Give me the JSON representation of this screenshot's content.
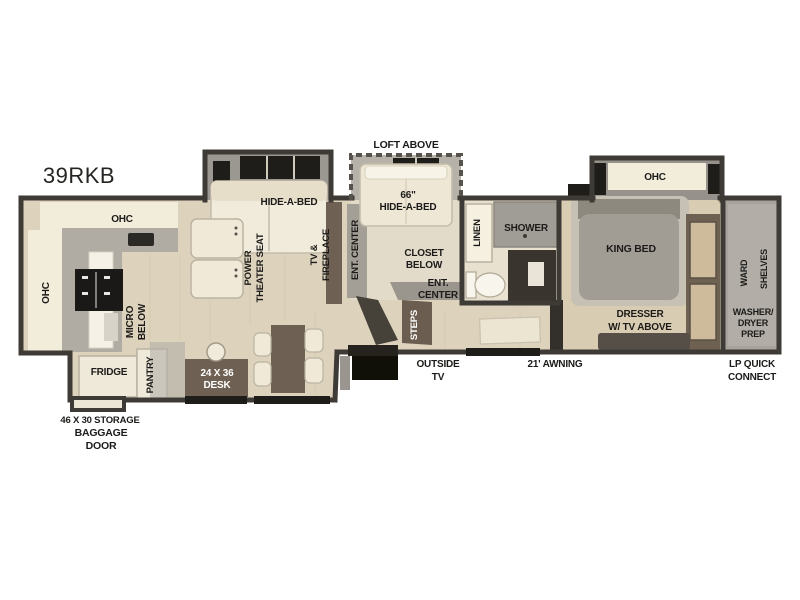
{
  "title": "39RKB",
  "colors": {
    "wall": "#3e3a35",
    "wood_floor": "#ddd2bb",
    "loft_floor": "#e3dbc9",
    "bath_floor": "#e9e1cf",
    "carpet": "#d8ccb2",
    "rear_floor": "#a7a39c",
    "slide_gray": "#9b9791",
    "counter_gray": "#b0aca4",
    "cabinet_cream": "#efe9d9",
    "sofa_cream": "#f1ebdb",
    "furniture_brown": "#6e6052",
    "appliance_black": "#1b1918",
    "label_text": "#1c1b19"
  },
  "labels": {
    "ohc_kitchen_top": "OHC",
    "ohc_kitchen_left": "OHC",
    "ohc_bedroom": "OHC",
    "micro_line1": "MICRO",
    "micro_line2": "BELOW",
    "fridge": "FRIDGE",
    "pantry": "PANTRY",
    "desk_line1": "24 X 36",
    "desk_line2": "DESK",
    "storage": "46 X 30 STORAGE",
    "baggage_line1": "BAGGAGE",
    "baggage_line2": "DOOR",
    "hide_a_bed": "HIDE-A-BED",
    "theater_line1": "POWER",
    "theater_line2": "THEATER SEAT",
    "tv_line1": "TV &",
    "tv_line2": "FIREPLACE",
    "loft_above": "LOFT ABOVE",
    "loft_bed_line1": "66\"",
    "loft_bed_line2": "HIDE-A-BED",
    "ent_center_vertical": "ENT. CENTER",
    "closet_line1": "CLOSET",
    "closet_line2": "BELOW",
    "ent_center_line1": "ENT.",
    "ent_center_line2": "CENTER",
    "steps": "STEPS",
    "outside_tv_line1": "OUTSIDE",
    "outside_tv_line2": "TV",
    "awning": "21' AWNING",
    "linen": "LINEN",
    "shower": "SHOWER",
    "king_bed": "KING BED",
    "dresser_line1": "DRESSER",
    "dresser_line2": "W/ TV ABOVE",
    "ward": "WARD",
    "shelves": "SHELVES",
    "washer_line1": "WASHER/",
    "washer_line2": "DRYER",
    "washer_line3": "PREP",
    "lp_line1": "LP QUICK",
    "lp_line2": "CONNECT"
  }
}
